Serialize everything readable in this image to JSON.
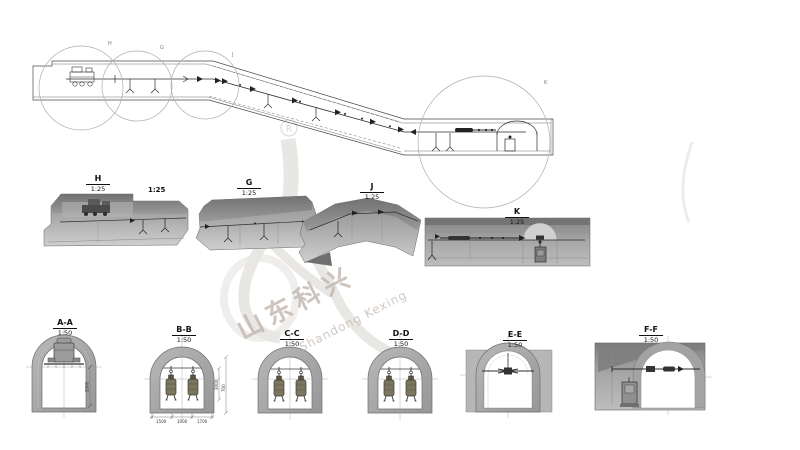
{
  "watermark": {
    "registered": "R",
    "cn": "山东科兴",
    "en": "Shandong Kexing"
  },
  "plan": {
    "detail_markers": [
      {
        "label": "H"
      },
      {
        "label": "G"
      },
      {
        "label": "J"
      },
      {
        "label": "K"
      }
    ]
  },
  "details": [
    {
      "id": "H",
      "scale": "1:25"
    },
    {
      "id": "G",
      "scale": "1:25"
    },
    {
      "id": "J",
      "scale": "1:25"
    },
    {
      "id": "K",
      "scale": "1:25"
    }
  ],
  "floating_scale": "1:25",
  "sections": [
    {
      "id": "A-A",
      "scale": "1:50"
    },
    {
      "id": "B-B",
      "scale": "1:50"
    },
    {
      "id": "C-C",
      "scale": "1:50"
    },
    {
      "id": "D-D",
      "scale": "1:50"
    },
    {
      "id": "E-E",
      "scale": "1:50"
    },
    {
      "id": "F-F",
      "scale": "1:50"
    }
  ],
  "dimensions": {
    "aa_height": "2000",
    "bb_height": "3000",
    "bb_height2": "700",
    "bb_w1": "1500",
    "bb_w2": "1000",
    "bb_w3": "1700"
  },
  "colors": {
    "line": "#3f3f3f",
    "face_light": "#cfcfcf",
    "face_mid": "#a5a5a5",
    "face_dark": "#747474",
    "watermark": "#cfc9c4",
    "equipment_olive": "#7b7660",
    "white": "#ffffff"
  }
}
